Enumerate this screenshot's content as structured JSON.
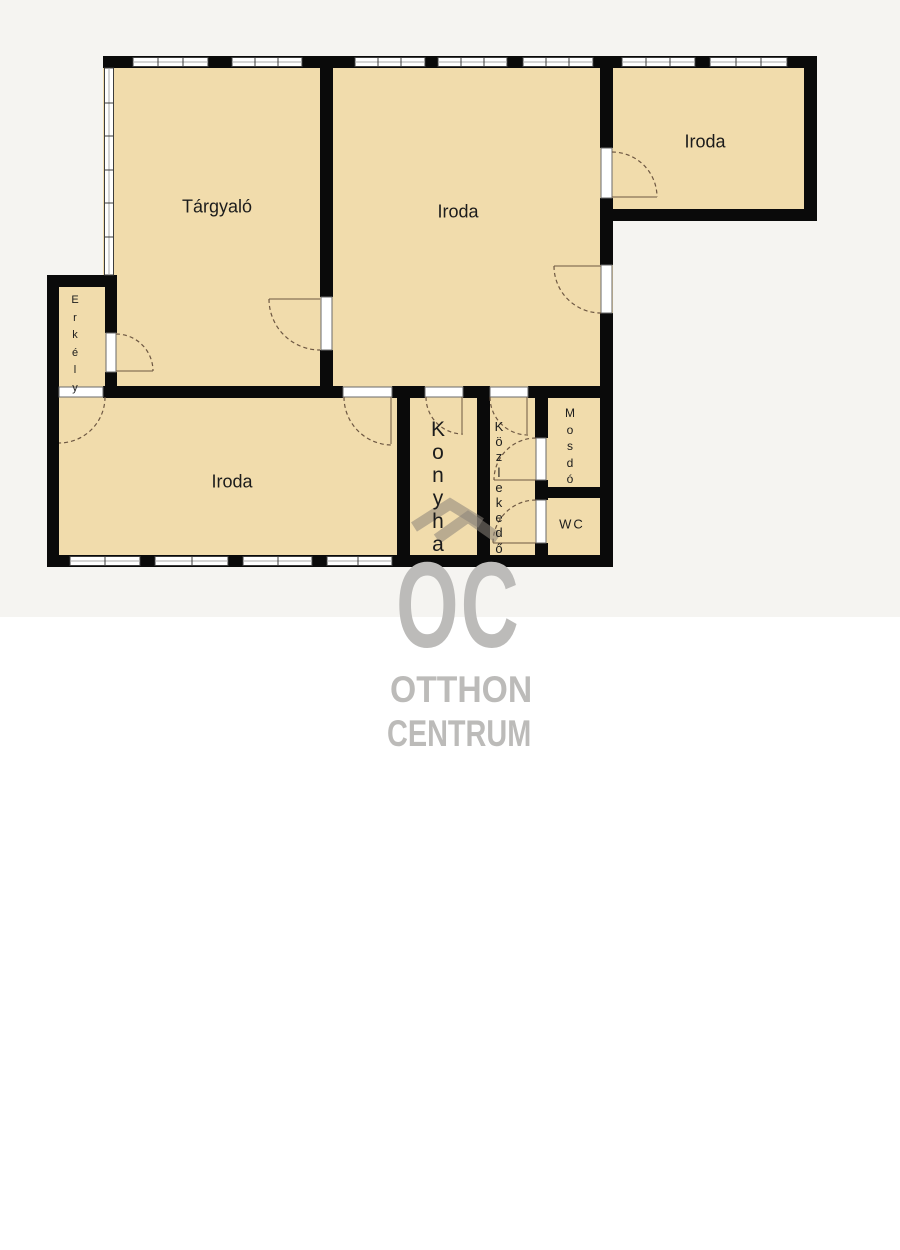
{
  "rooms": {
    "targyalo": {
      "label": "Tárgyaló"
    },
    "iroda_center": {
      "label": "Iroda"
    },
    "iroda_right": {
      "label": "Iroda"
    },
    "iroda_bottom": {
      "label": "Iroda"
    },
    "erkely": {
      "label": "Erkély"
    },
    "konyha": {
      "label": "Konyha"
    },
    "kozlekedo": {
      "label": "Közlekedő"
    },
    "mosdo": {
      "label": "Mosdó"
    },
    "wc": {
      "label": "WC"
    }
  },
  "watermark": {
    "initials": "OC",
    "brand_line1": "OTTHON",
    "brand_line2": "CENTRUM"
  },
  "colors": {
    "room_fill": "#f1dcac",
    "wall": "#0a0a0a",
    "bg_upper": "#f5f4f1",
    "bg_lower": "#ffffff",
    "watermark_gray": "#bcbbb9",
    "door_arc": "#6d5742",
    "label_text": "#1c1c1c"
  }
}
